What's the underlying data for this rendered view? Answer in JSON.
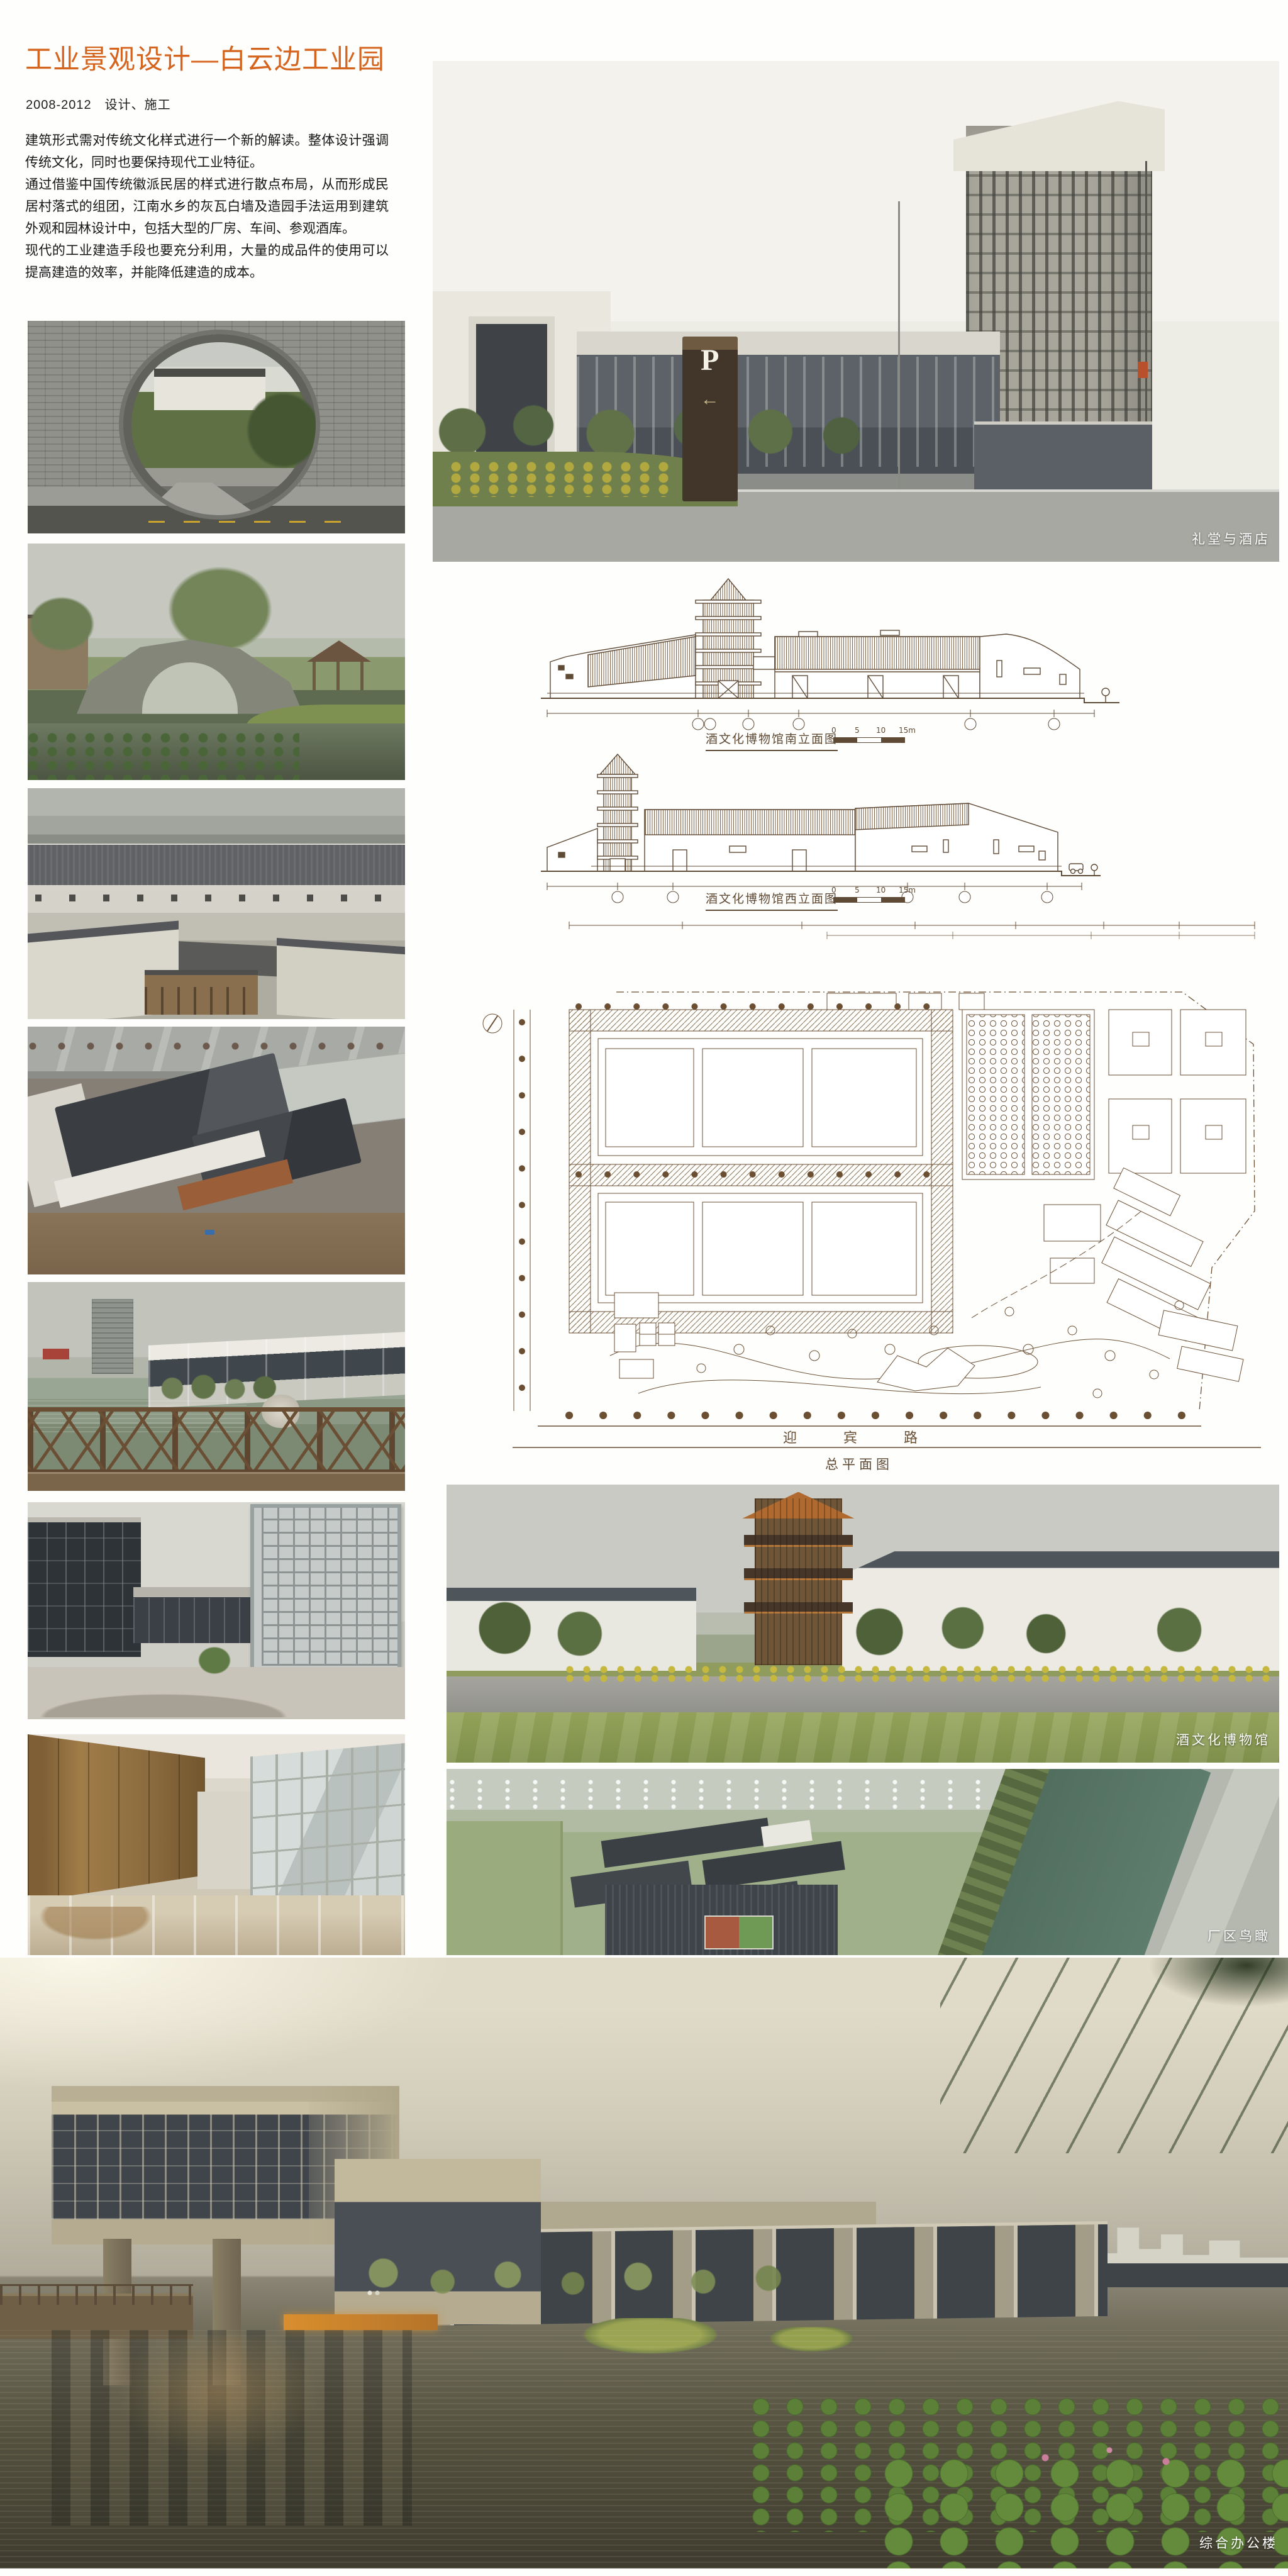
{
  "header": {
    "title": "工业景观设计—白云边工业园",
    "meta": "2008-2012　设计、施工"
  },
  "intro": {
    "p1": "建筑形式需对传统文化样式进行一个新的解读。整体设计强调传统文化，同时也要保持现代工业特征。",
    "p2": "通过借鉴中国传统徽派民居的样式进行散点布局，从而形成民居村落式的组团，江南水乡的灰瓦白墙及造园手法运用到建筑外观和园林设计中，包括大型的厂房、车间、参观酒库。",
    "p3": "现代的工业建造手段也要充分利用，大量的成品件的使用可以提高建造的效率，并能降低建造的成本。"
  },
  "captions": {
    "hall": "礼堂与酒店",
    "museum": "酒文化博物馆",
    "factory": "厂区鸟瞰",
    "office": "综合办公楼"
  },
  "drawings": {
    "scale": [
      "0",
      "5",
      "10",
      "15m"
    ],
    "south": {
      "title": "酒文化博物馆南立面图"
    },
    "west": {
      "title": "酒文化博物馆西立面图"
    },
    "plan": {
      "title": "总平面图",
      "road": "迎宾路"
    }
  },
  "labels": {
    "parking": "P",
    "parking_arrow": "←"
  },
  "colors": {
    "accent_orange": "#d4641e",
    "drawing_ink": "#5f4a35",
    "caption_white": "#ffffff"
  }
}
